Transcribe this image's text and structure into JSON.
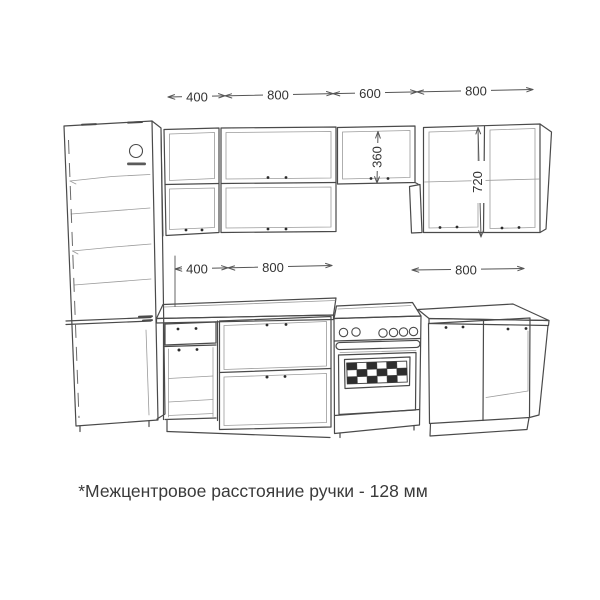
{
  "note": "*Межцентровое расстояние ручки - 128 мм",
  "dimensions": {
    "upper_row": [
      "400",
      "800",
      "600",
      "800"
    ],
    "base_row": [
      "400",
      "800",
      "800"
    ],
    "cabinet_heights": [
      "360",
      "720"
    ]
  },
  "colors": {
    "background": "#ffffff",
    "line": "#4a4a4a",
    "faint_line": "#9b9b9b",
    "dim_text": "#333333",
    "note_text": "#3a3a3a"
  }
}
